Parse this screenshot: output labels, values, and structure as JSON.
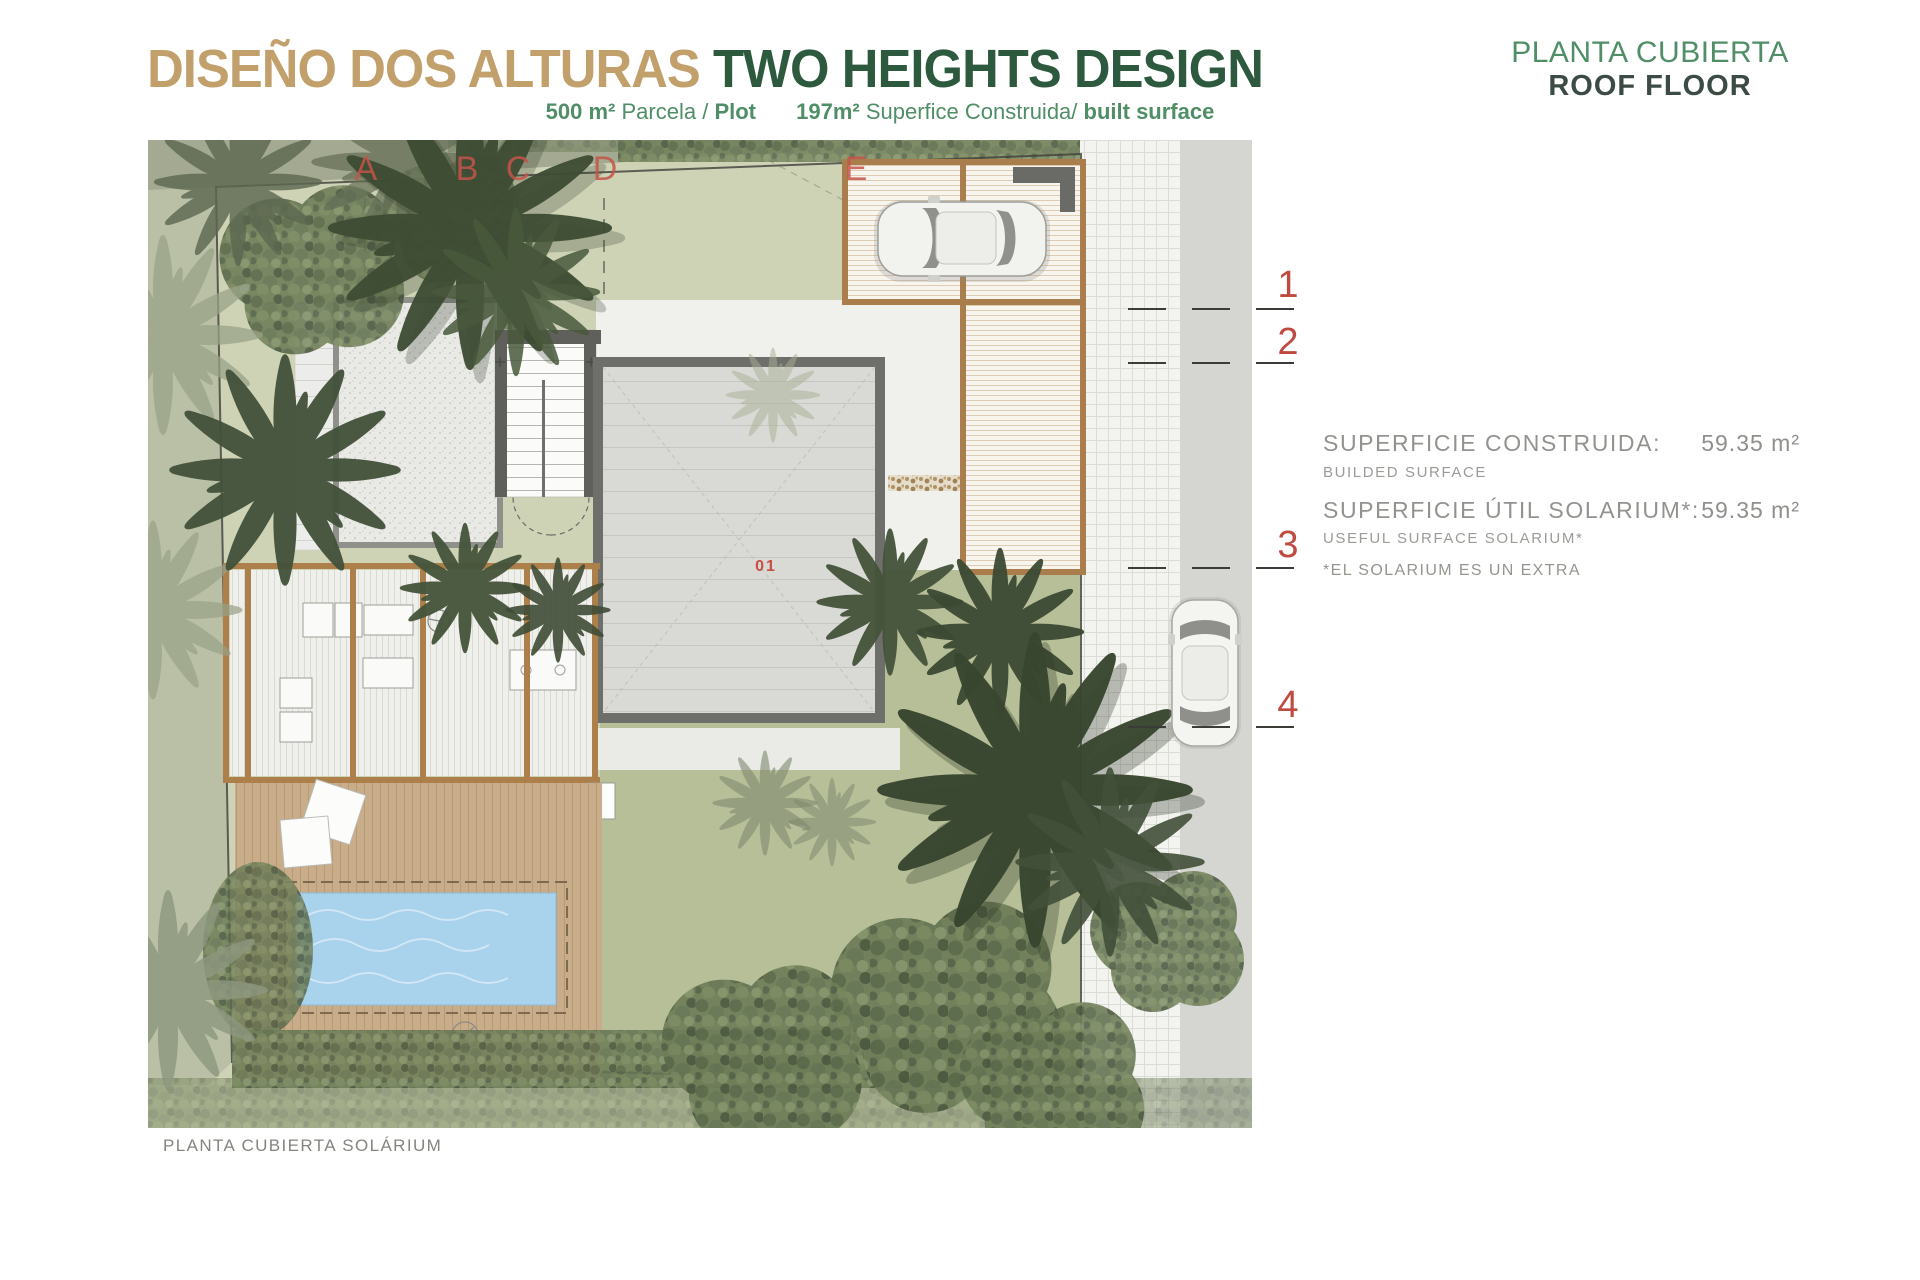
{
  "header": {
    "title_es": "DISEÑO DOS ALTURAS",
    "title_en": "TWO HEIGHTS DESIGN",
    "subtitle": {
      "plot_value": "500 m²",
      "plot_label": "Parcela /",
      "plot_label_bold": "Plot",
      "built_value": "197m²",
      "built_label": "Superfice Construida/",
      "built_label_bold": "built surface"
    },
    "sheet_title_es": "PLANTA CUBIERTA",
    "sheet_title_en": "ROOF FLOOR"
  },
  "annotations": {
    "built": {
      "label": "SUPERFICIE CONSTRUIDA:",
      "sublabel": "BUILDED SURFACE",
      "value": "59.35",
      "unit": "m²"
    },
    "solarium": {
      "label": "SUPERFICIE ÚTIL SOLARIUM*:",
      "sublabel": "USEFUL SURFACE SOLARIUM*",
      "value": "59.35",
      "unit": "m²"
    },
    "note": "*EL SOLARIUM ES UN EXTRA"
  },
  "plan": {
    "caption": "PLANTA CUBIERTA SOLÁRIUM",
    "grid_letters": [
      "A",
      "B",
      "C",
      "D",
      "E"
    ],
    "grid_numbers": [
      "1",
      "2",
      "3",
      "4"
    ],
    "roof_label": "01"
  },
  "colors": {
    "title_gold": "#c2a06b",
    "title_green": "#2d5a3e",
    "subtitle_green": "#4f8e66",
    "marker_red": "#c5544a",
    "annotation_gray": "#92928e",
    "pool_blue": "#a9d2ec",
    "deck_tan": "#c9ad8a",
    "pergola_brown": "#ad7f4b",
    "garden_sage": "#cfd3b6",
    "lawn_green": "#aab388",
    "road_gray": "#d5d5d2"
  }
}
